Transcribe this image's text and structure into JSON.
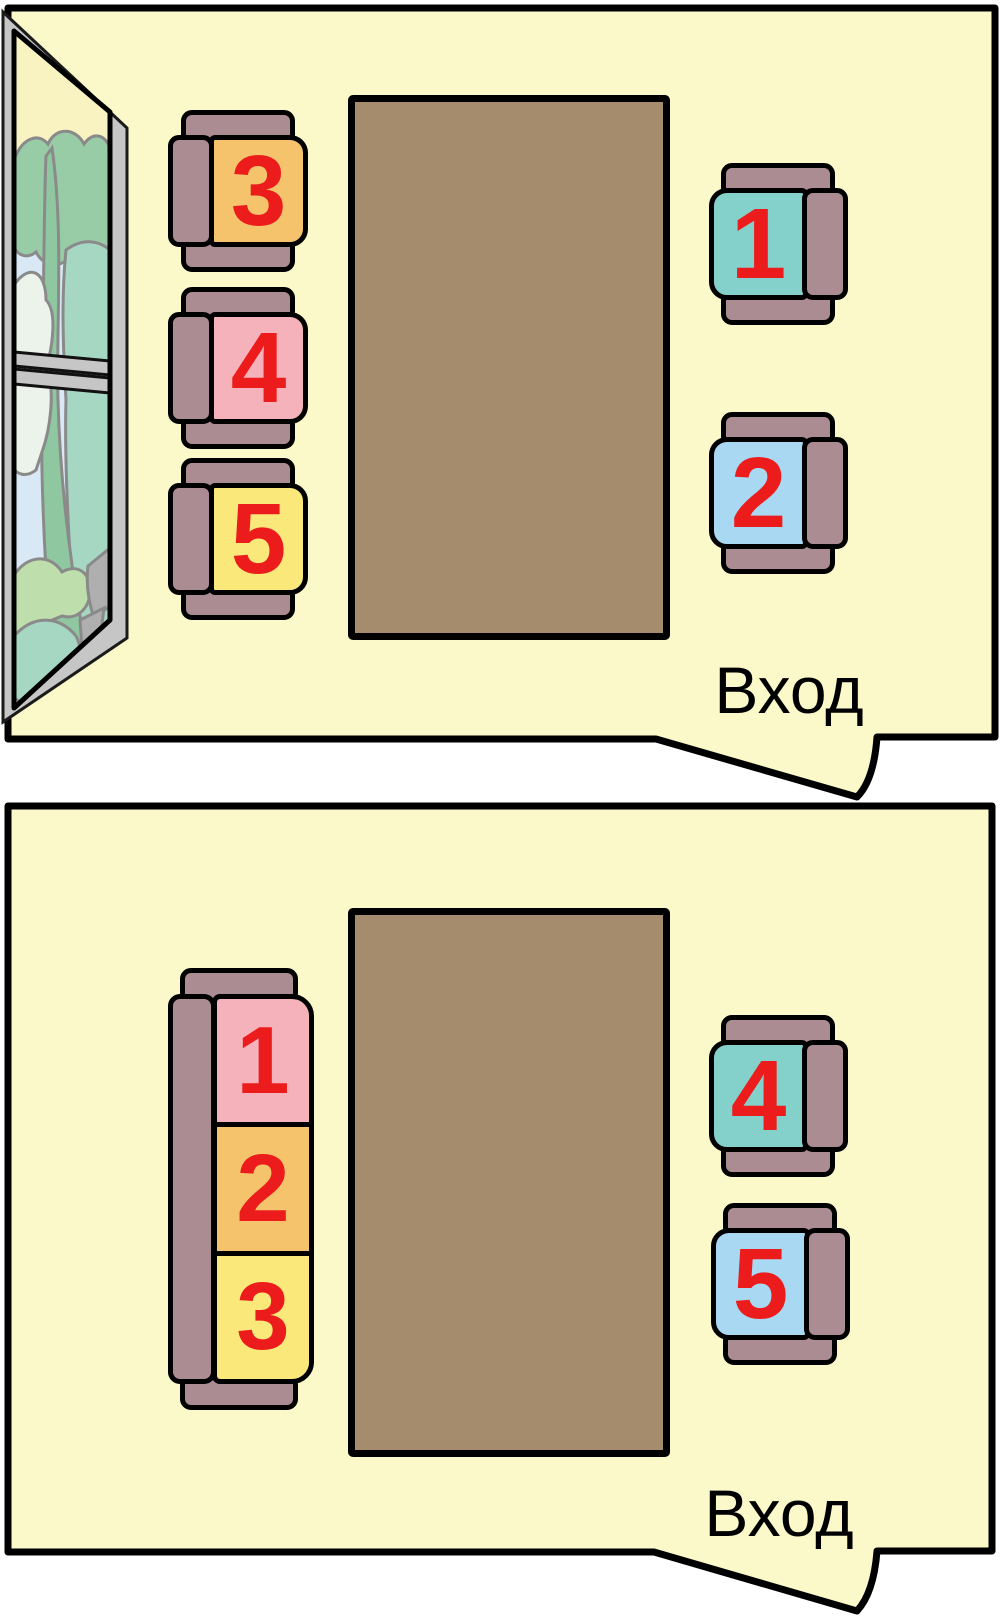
{
  "colors": {
    "room_fill": "#FBF8C9",
    "outline": "#000000",
    "table": "#A58C6C",
    "frame": "#AB8C92",
    "number_red": "#ED1C1C",
    "window_frame": "#C6C6C6",
    "window": {
      "pane_base": "#D8E9F5",
      "sky_yellow": "#F9F3C2",
      "canopy_green": "#97CCA7",
      "hill_teal": "#A6D7C3",
      "trunk_green": "#8FC8A0",
      "cloud_white": "#ECF3EB",
      "bush_light_green": "#BEDFAC",
      "rock_gray": "#AFAFAF"
    }
  },
  "rooms": [
    {
      "name": "room-with-window",
      "entrance_label": "Вход",
      "left_seats": [
        {
          "number": "3",
          "color": "#F4C36C"
        },
        {
          "number": "4",
          "color": "#F5B2BA"
        },
        {
          "number": "5",
          "color": "#FAE87A"
        }
      ],
      "right_seats": [
        {
          "number": "1",
          "color": "#84D0CA"
        },
        {
          "number": "2",
          "color": "#A8D8F2"
        }
      ]
    },
    {
      "name": "room-with-sofa",
      "entrance_label": "Вход",
      "sofa_seats": [
        {
          "number": "1",
          "color": "#F5B2BA"
        },
        {
          "number": "2",
          "color": "#F4C36C"
        },
        {
          "number": "3",
          "color": "#FAE87A"
        }
      ],
      "right_seats": [
        {
          "number": "4",
          "color": "#84D0CA"
        },
        {
          "number": "5",
          "color": "#A8D8F2"
        }
      ]
    }
  ]
}
